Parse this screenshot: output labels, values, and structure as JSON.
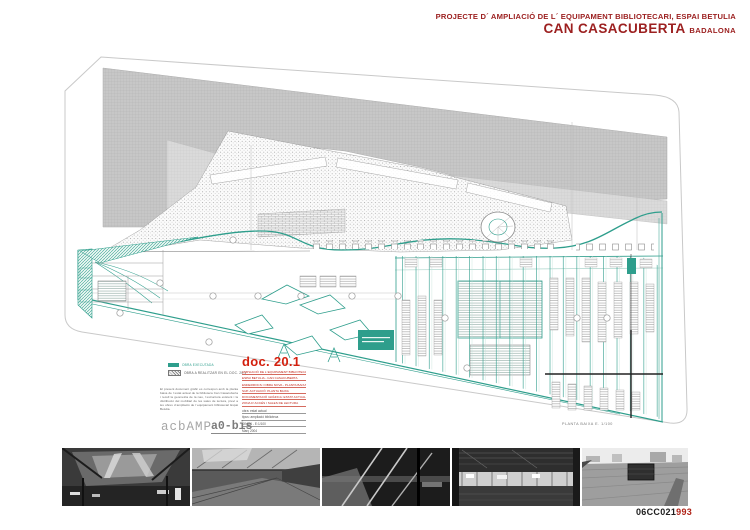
{
  "header": {
    "project_line": "PROJECTE D´ AMPLIACIÓ DE L´ EQUIPAMENT BIBLIOTECARI, ESPAI BETULIA",
    "building": "CAN CASACUBERTA",
    "city": "BADALONA"
  },
  "plan": {
    "caption": "PLANTA BAIXA E. 1/100"
  },
  "legend": {
    "items": [
      {
        "swatch": "solid",
        "label": "OBRA EXECUTADA"
      },
      {
        "swatch": "hatch",
        "label": "OBRA A REALITZAR EN EL DOC. 20.1"
      }
    ]
  },
  "description": {
    "paragraph": "El present document gràfic es correspon amb la planta baixa de l´estat actual de la biblioteca Can Casacuberta i recull la geometria de la nau, l´estructura existent i la distribució del mobiliari de les sales de lectura, previ a les obres d´ampliació de l´equipament bibliotecari Espai Betulia."
  },
  "doc_block": {
    "doc_label": "doc. 20.1",
    "lines": [
      "AMPLIACIÓ DE L´EQUIPAMENT BIBLIOTECARI",
      "ESPAI BETULIA - CAN CASACUBERTA",
      "ENDERROCS I OBRA NOVA - PLANTA BAIXA",
      "SUP. ACTUACIÓ: PLANTA BAIXA",
      "DOCUMENTACIÓ GRÀFICA: ESTAT ACTUAL",
      "ZONA D´ACCÉS I SALES DE LECTURA"
    ]
  },
  "titleblock": {
    "firm": "acbAMP",
    "sheet": "a0-bis",
    "specs": [
      "obra: estat actual",
      "tipus: ampliació biblioteca",
      "DIN A1  -  E:1/100",
      "Març 2004"
    ]
  },
  "footer": {
    "code_black": "06CC021",
    "code_red": "993"
  },
  "colors": {
    "accent_red": "#9c2020",
    "doc_red": "#d3200e",
    "teal": "#2e9e8c",
    "roof_gray": "#c7c7c7"
  }
}
